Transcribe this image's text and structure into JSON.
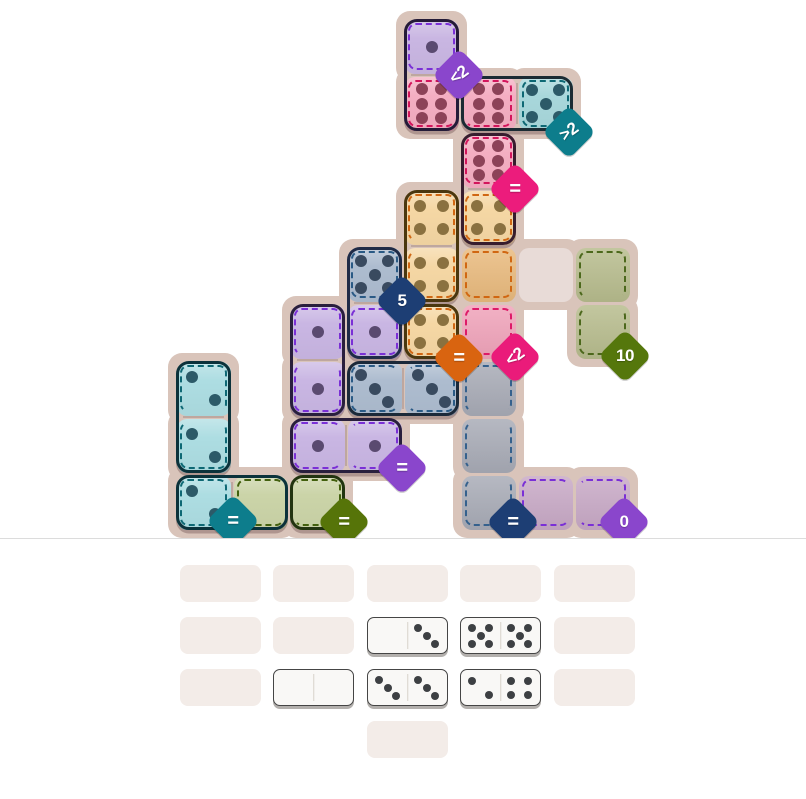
{
  "board": {
    "origin": {
      "x": 175,
      "y": 18
    },
    "cell_size": 57,
    "background_color": "#d9c4ba",
    "regions": {
      "purple": {
        "fill": "#c9b6e2",
        "empty": "#c9b6e2",
        "dash": "#7a2fd6",
        "pip": "#5a4a70"
      },
      "pink": {
        "fill": "#f4aec2",
        "empty": "#f09fb6",
        "dash": "#d3155c",
        "pip": "#8c4258"
      },
      "tealTop": {
        "fill": "#a8d7db",
        "empty": "#a8d7db",
        "dash": "#0e6874",
        "pip": "#2c5a68"
      },
      "orange": {
        "fill": "#f5d7a4",
        "empty": "#e9ba7d",
        "dash": "#d06712",
        "pip": "#8a7140"
      },
      "pinkLt": {
        "fill": "#f0a3ba",
        "empty": "#f0a3ba",
        "dash": "#dd1a68",
        "pip": "#8c4258"
      },
      "slate": {
        "fill": "#adbccf",
        "empty": "#adbccf",
        "dash": "#2a5a85",
        "pip": "#394a5f"
      },
      "lavender": {
        "fill": "#c9b6e3",
        "empty": "#c9b6e3",
        "dash": "#7a2fd6",
        "pip": "#5a4a70"
      },
      "tealBL": {
        "fill": "#addde2",
        "empty": "#addde2",
        "dash": "#0e6874",
        "pip": "#2c5a68"
      },
      "oliveBL": {
        "fill": "#cbd4a8",
        "empty": "#cbd4a8",
        "dash": "#43600e",
        "pip": "#4a5a20"
      },
      "oliveR": {
        "fill": "#b7bc8d",
        "empty": "#b7bc8d",
        "dash": "#4c681c",
        "pip": "#4a5a20"
      },
      "gray": {
        "fill": "#a8abb6",
        "empty": "#a8abb6",
        "dash": "#35618d",
        "pip": "#444a58"
      },
      "mauve": {
        "fill": "#c8a9c6",
        "empty": "#c8a9c6",
        "dash": "#7a2fd6",
        "pip": "#5a4a70"
      },
      "plain": {
        "fill": "#e8dbd7",
        "empty": "#e8dbd7",
        "dash": "transparent",
        "pip": "#888888"
      }
    },
    "cells": [
      {
        "r": 0,
        "c": 4,
        "region": "purple",
        "pips": 1,
        "state": "placed",
        "dash": "trbl"
      },
      {
        "r": 1,
        "c": 4,
        "region": "pink",
        "pips": 6,
        "state": "placed",
        "dash": "tbl"
      },
      {
        "r": 1,
        "c": 5,
        "region": "pink",
        "pips": 6,
        "state": "placed",
        "dash": "trb"
      },
      {
        "r": 1,
        "c": 6,
        "region": "tealTop",
        "pips": 5,
        "state": "placed",
        "dash": "trbl"
      },
      {
        "r": 2,
        "c": 5,
        "region": "pink",
        "pips": 6,
        "state": "placed",
        "dash": "trbl"
      },
      {
        "r": 3,
        "c": 4,
        "region": "orange",
        "pips": 4,
        "state": "placed",
        "dash": "trl"
      },
      {
        "r": 3,
        "c": 5,
        "region": "orange",
        "pips": 4,
        "state": "placed",
        "dash": "trbl"
      },
      {
        "r": 4,
        "c": 3,
        "region": "slate",
        "pips": 5,
        "state": "placed",
        "dash": "trbl"
      },
      {
        "r": 4,
        "c": 4,
        "region": "orange",
        "pips": 4,
        "state": "placed",
        "dash": "rbl"
      },
      {
        "r": 4,
        "c": 5,
        "region": "orange",
        "pips": 0,
        "state": "empty",
        "dash": "trbl"
      },
      {
        "r": 4,
        "c": 6,
        "region": "plain",
        "pips": 0,
        "state": "plain",
        "dash": ""
      },
      {
        "r": 4,
        "c": 7,
        "region": "oliveR",
        "pips": 0,
        "state": "empty",
        "dash": "trl"
      },
      {
        "r": 5,
        "c": 2,
        "region": "lavender",
        "pips": 1,
        "state": "placed",
        "dash": "trl"
      },
      {
        "r": 5,
        "c": 3,
        "region": "lavender",
        "pips": 1,
        "state": "placed",
        "dash": "trbl"
      },
      {
        "r": 5,
        "c": 4,
        "region": "orange",
        "pips": 4,
        "state": "placed",
        "dash": "trbl"
      },
      {
        "r": 5,
        "c": 5,
        "region": "pinkLt",
        "pips": 0,
        "state": "empty",
        "dash": "trbl"
      },
      {
        "r": 5,
        "c": 7,
        "region": "oliveR",
        "pips": 0,
        "state": "empty",
        "dash": "rbl"
      },
      {
        "r": 6,
        "c": 0,
        "region": "tealBL",
        "pips": 2,
        "state": "placed",
        "dash": "trl"
      },
      {
        "r": 6,
        "c": 2,
        "region": "lavender",
        "pips": 1,
        "state": "placed",
        "dash": "rbl"
      },
      {
        "r": 6,
        "c": 3,
        "region": "slate",
        "pips": 3,
        "state": "placed",
        "dash": "tbl"
      },
      {
        "r": 6,
        "c": 4,
        "region": "slate",
        "pips": 3,
        "state": "placed",
        "dash": "trb"
      },
      {
        "r": 6,
        "c": 5,
        "region": "gray",
        "pips": 0,
        "state": "empty",
        "dash": "trl"
      },
      {
        "r": 7,
        "c": 0,
        "region": "tealBL",
        "pips": 2,
        "state": "placed",
        "dash": "rbl"
      },
      {
        "r": 7,
        "c": 2,
        "region": "lavender",
        "pips": 1,
        "state": "placed",
        "dash": "tbl"
      },
      {
        "r": 7,
        "c": 3,
        "region": "lavender",
        "pips": 1,
        "state": "placed",
        "dash": "trb"
      },
      {
        "r": 7,
        "c": 5,
        "region": "gray",
        "pips": 0,
        "state": "empty",
        "dash": "rl"
      },
      {
        "r": 8,
        "c": 0,
        "region": "tealBL",
        "pips": 2,
        "state": "placed",
        "dash": "trbl"
      },
      {
        "r": 8,
        "c": 1,
        "region": "oliveBL",
        "pips": 0,
        "state": "placed",
        "dash": "tbl"
      },
      {
        "r": 8,
        "c": 2,
        "region": "oliveBL",
        "pips": 0,
        "state": "placed",
        "dash": "trb"
      },
      {
        "r": 8,
        "c": 5,
        "region": "gray",
        "pips": 0,
        "state": "empty",
        "dash": "rbl"
      },
      {
        "r": 8,
        "c": 6,
        "region": "mauve",
        "pips": 0,
        "state": "empty",
        "dash": "tbl"
      },
      {
        "r": 8,
        "c": 7,
        "region": "mauve",
        "pips": 0,
        "state": "empty",
        "dash": "trb"
      }
    ],
    "dominoes": [
      {
        "cells": [
          [
            0,
            4
          ],
          [
            1,
            4
          ]
        ],
        "values": [
          1,
          6
        ],
        "outline": "#241b38"
      },
      {
        "cells": [
          [
            1,
            5
          ],
          [
            1,
            6
          ]
        ],
        "values": [
          6,
          5
        ],
        "outline": "#1b2b33"
      },
      {
        "cells": [
          [
            2,
            5
          ],
          [
            3,
            5
          ]
        ],
        "values": [
          6,
          4
        ],
        "outline": "#371d2e"
      },
      {
        "cells": [
          [
            3,
            4
          ],
          [
            4,
            4
          ]
        ],
        "values": [
          4,
          4
        ],
        "outline": "#4a370f"
      },
      {
        "cells": [
          [
            5,
            4
          ]
        ],
        "values": [
          4
        ],
        "outline": "#4a370f"
      },
      {
        "cells": [
          [
            4,
            3
          ],
          [
            5,
            3
          ]
        ],
        "values": [
          5,
          1
        ],
        "outline": "#1f2b47"
      },
      {
        "cells": [
          [
            5,
            2
          ],
          [
            6,
            2
          ]
        ],
        "values": [
          1,
          1
        ],
        "outline": "#291f3d"
      },
      {
        "cells": [
          [
            6,
            3
          ],
          [
            6,
            4
          ]
        ],
        "values": [
          3,
          3
        ],
        "outline": "#1b2939"
      },
      {
        "cells": [
          [
            7,
            2
          ],
          [
            7,
            3
          ]
        ],
        "values": [
          1,
          1
        ],
        "outline": "#291f3d"
      },
      {
        "cells": [
          [
            6,
            0
          ],
          [
            7,
            0
          ]
        ],
        "values": [
          2,
          2
        ],
        "outline": "#0b323b"
      },
      {
        "cells": [
          [
            8,
            0
          ],
          [
            8,
            1
          ]
        ],
        "values": [
          2,
          0
        ],
        "outline": "#0b323b"
      },
      {
        "cells": [
          [
            8,
            2
          ]
        ],
        "values": [
          0
        ],
        "outline": "#223410"
      }
    ],
    "badges": [
      {
        "label": "<2",
        "color": "#8a46cc",
        "x": 459,
        "y": 75,
        "tilt": -36
      },
      {
        "label": ">2",
        "color": "#0d7d8c",
        "x": 569,
        "y": 132,
        "tilt": -36
      },
      {
        "label": "=",
        "color": "#ec1c7c",
        "x": 515,
        "y": 189,
        "tilt": 0
      },
      {
        "label": "5",
        "color": "#1d3e74",
        "x": 402,
        "y": 301,
        "tilt": 0
      },
      {
        "label": "=",
        "color": "#d96410",
        "x": 459,
        "y": 358,
        "tilt": 0
      },
      {
        "label": "<2",
        "color": "#ea1b7a",
        "x": 515,
        "y": 357,
        "tilt": -36
      },
      {
        "label": "10",
        "color": "#55770c",
        "x": 625,
        "y": 356,
        "tilt": 0
      },
      {
        "label": "=",
        "color": "#8a46cc",
        "x": 402,
        "y": 468,
        "tilt": 0
      },
      {
        "label": "=",
        "color": "#0d7d8c",
        "x": 233,
        "y": 521,
        "tilt": 0
      },
      {
        "label": "=",
        "color": "#567409",
        "x": 344,
        "y": 522,
        "tilt": 0
      },
      {
        "label": "=",
        "color": "#1d3e74",
        "x": 513,
        "y": 522,
        "tilt": 0
      },
      {
        "label": "0",
        "color": "#8a46cc",
        "x": 624,
        "y": 522,
        "tilt": 0
      }
    ],
    "divider_y": 538
  },
  "tray": {
    "slot_size": {
      "w": 81,
      "h": 37
    },
    "slots": [
      {
        "x": 180,
        "y": 565
      },
      {
        "x": 273,
        "y": 565
      },
      {
        "x": 367,
        "y": 565
      },
      {
        "x": 460,
        "y": 565
      },
      {
        "x": 554,
        "y": 565
      },
      {
        "x": 180,
        "y": 617
      },
      {
        "x": 273,
        "y": 617
      },
      {
        "x": 554,
        "y": 617
      },
      {
        "x": 180,
        "y": 669
      },
      {
        "x": 554,
        "y": 669
      },
      {
        "x": 367,
        "y": 721
      }
    ],
    "dominoes": [
      {
        "x": 367,
        "y": 617,
        "values": [
          0,
          3
        ]
      },
      {
        "x": 460,
        "y": 617,
        "values": [
          5,
          5
        ]
      },
      {
        "x": 273,
        "y": 669,
        "values": [
          0,
          0
        ]
      },
      {
        "x": 367,
        "y": 669,
        "values": [
          3,
          3
        ]
      },
      {
        "x": 460,
        "y": 669,
        "values": [
          2,
          4
        ]
      }
    ],
    "pip_color": "#3d4043"
  }
}
